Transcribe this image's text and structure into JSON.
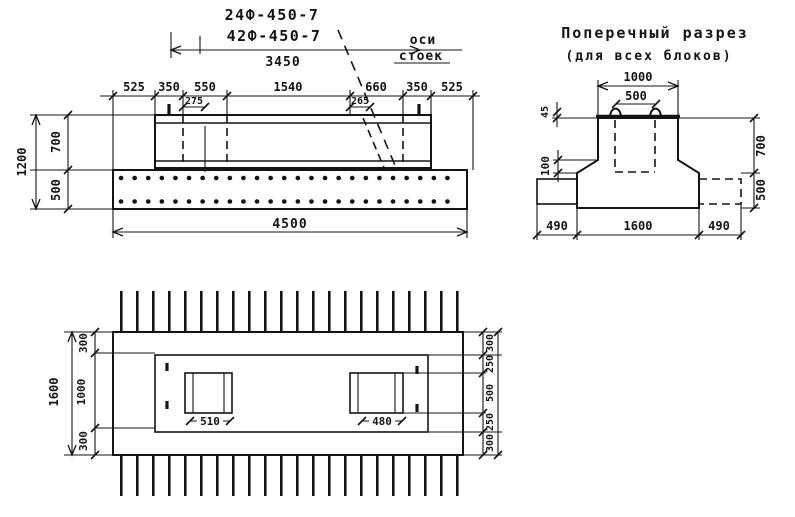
{
  "elevation": {
    "mark_top": "24Ф-450-7",
    "mark_bottom": "42Ф-450-7",
    "axis_note_line1": "оси",
    "axis_note_line2": "стоек",
    "dim_beam_length": "3450",
    "top_chain": [
      "525",
      "350",
      "550",
      "1540",
      "660",
      "350",
      "525"
    ],
    "dim_left_post_axis": "275",
    "dim_right_post_axis": "265",
    "dim_height_total": "1200",
    "dim_height_beam": "700",
    "dim_height_slab": "500",
    "dim_total_length": "4500"
  },
  "cross_section": {
    "title_line1": "Поперечный разрез",
    "title_line2": "(для всех блоков)",
    "dim_top_width": "1000",
    "dim_opening_width": "500",
    "dim_top_lip": "45",
    "dim_bevel_height": "100",
    "dim_upper_height": "700",
    "dim_base_height": "500",
    "dim_left_overhang": "490",
    "dim_base_width": "1600",
    "dim_right_overhang": "490"
  },
  "plan": {
    "dim_width_total": "1600",
    "left_chain": [
      "300",
      "1000",
      "300"
    ],
    "right_chain": [
      "300",
      "250",
      "500",
      "250",
      "300"
    ],
    "dim_left_socket": "510",
    "dim_right_socket": "480"
  }
}
